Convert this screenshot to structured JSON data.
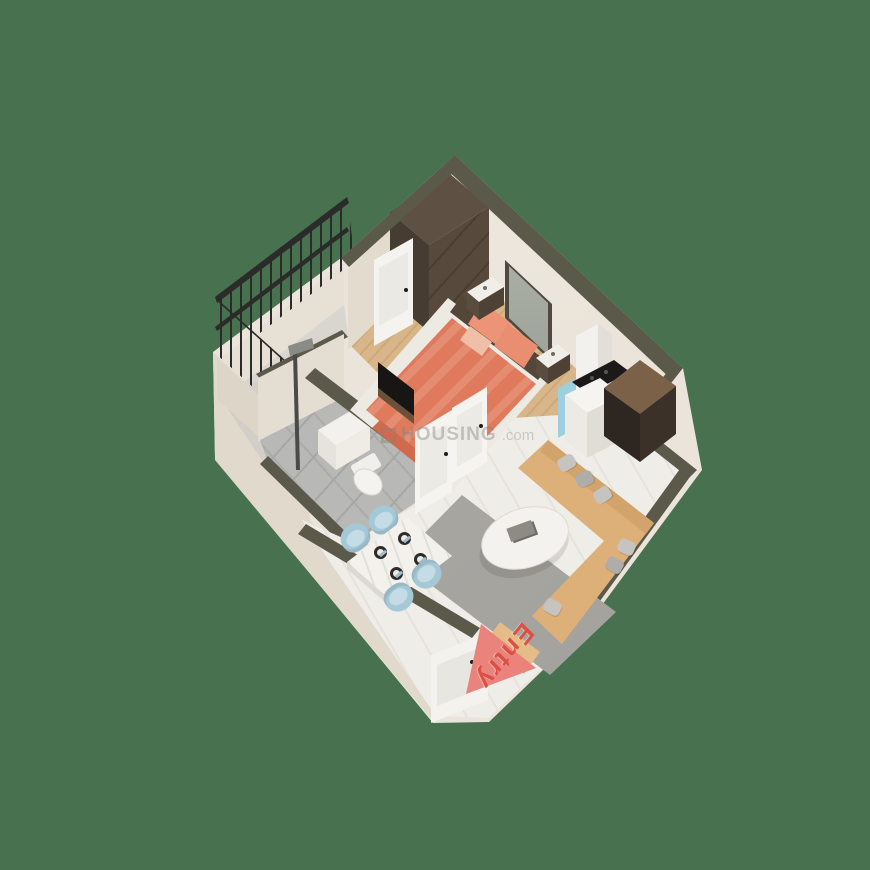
{
  "image_type": "3d-isometric-floor-plan-render",
  "watermark": {
    "logo_glyph": "square-logo",
    "text": "HOUSING",
    "suffix": ".com"
  },
  "entry": {
    "label": "Entry"
  },
  "palette": {
    "bg": "#47714F",
    "wallTop": "#5B594A",
    "wallFace": "#EAE4DA",
    "wallShade": "#E0D9CC",
    "wood": "#D8B689",
    "tile": "#B8B8B6",
    "marble": "#EFEDE8",
    "balconyFloor": "#D9D6D0",
    "rug": "#A9A8A3",
    "coral": "#E07A5C",
    "coralLight": "#EC9478",
    "brown": "#54473A",
    "sofa": "#DDAF79",
    "chairBlue": "#A5C8D6",
    "kitchenBlue": "#9ECFDE",
    "railing": "#2B2B29",
    "arrow": "#E9837B",
    "entryText": "#DC4F45",
    "watermark": "rgba(130,130,124,0.42)"
  },
  "rooms": {
    "bedroom": {
      "floor": "wood-plank",
      "items": [
        "wardrobe",
        "balcony-door",
        "double-bed",
        "coral-duvet",
        "pillows",
        "nightstand-left",
        "nightstand-right",
        "wall-art",
        "tv-panel"
      ]
    },
    "balcony": {
      "floor": "stone",
      "items": [
        "wrought-iron-railing"
      ]
    },
    "bathroom": {
      "floor": "gray-tile",
      "items": [
        "shower",
        "vanity-sink",
        "toilet",
        "bathroom-door"
      ]
    },
    "kitchen": {
      "floor": "marble",
      "items": [
        "chimney-hood",
        "cooktop",
        "blue-cabinet",
        "counter",
        "tall-dark-cabinet"
      ]
    },
    "living_dining": {
      "floor": "marble",
      "items": [
        "l-shaped-sofa",
        "gray-cushions",
        "round-coffee-table",
        "gray-rug",
        "dining-table",
        "dining-chairs",
        "place-settings",
        "entry-door",
        "entry-arrow"
      ]
    }
  }
}
